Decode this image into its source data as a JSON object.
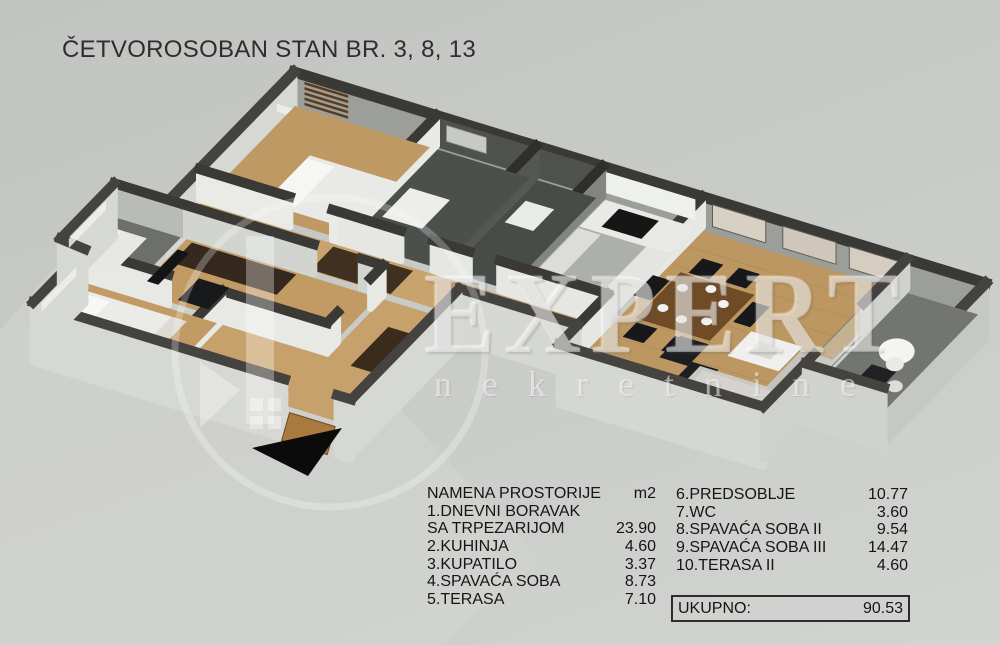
{
  "title": "ČETVOROSOBAN STAN BR. 3, 8, 13",
  "watermark": {
    "brand": "EXPERT",
    "tagline": "nekretnine"
  },
  "legend": {
    "header_label": "NAMENA PROSTORIJE",
    "header_unit": "m2",
    "left_rows": [
      {
        "label": "1.DNEVNI BORAVAK",
        "value": ""
      },
      {
        "label": "SA TRPEZARIJOM",
        "value": "23.90"
      },
      {
        "label": "2.KUHINJA",
        "value": "4.60"
      },
      {
        "label": "3.KUPATILO",
        "value": "3.37"
      },
      {
        "label": "4.SPAVAĆA SOBA",
        "value": "8.73"
      },
      {
        "label": "5.TERASA",
        "value": "7.10"
      }
    ],
    "right_rows": [
      {
        "label": "6.PREDSOBLJE",
        "value": "10.77"
      },
      {
        "label": "7.WC",
        "value": "3.60"
      },
      {
        "label": "8.SPAVAĆA SOBA II",
        "value": "9.54"
      },
      {
        "label": "9.SPAVAĆA SOBA III",
        "value": "14.47"
      },
      {
        "label": "10.TERASA II",
        "value": "4.60"
      }
    ],
    "total": {
      "label": "UKUPNO:",
      "value": "90.53"
    }
  },
  "floor_plan": {
    "view": "3d-isometric apartment render",
    "entrance_arrow": "black triangle pointing to entrance door"
  },
  "colors": {
    "background": "#c7c9c6",
    "wall_top": "#3b3935",
    "outer_wall_face": "#d6d8d4",
    "inner_back_wall": "#9c9e99",
    "wood_floor": "#bf9963",
    "corridor_floor": "#c9a36d",
    "bath_floor": "#4c504d",
    "kitchen_floor": "#adafab",
    "terrace_floor": "#737670",
    "furniture_dark_wood": "#3f3020",
    "arrow": "#0b0b0b",
    "watermark": "rgba(255,255,255,0.42)"
  }
}
